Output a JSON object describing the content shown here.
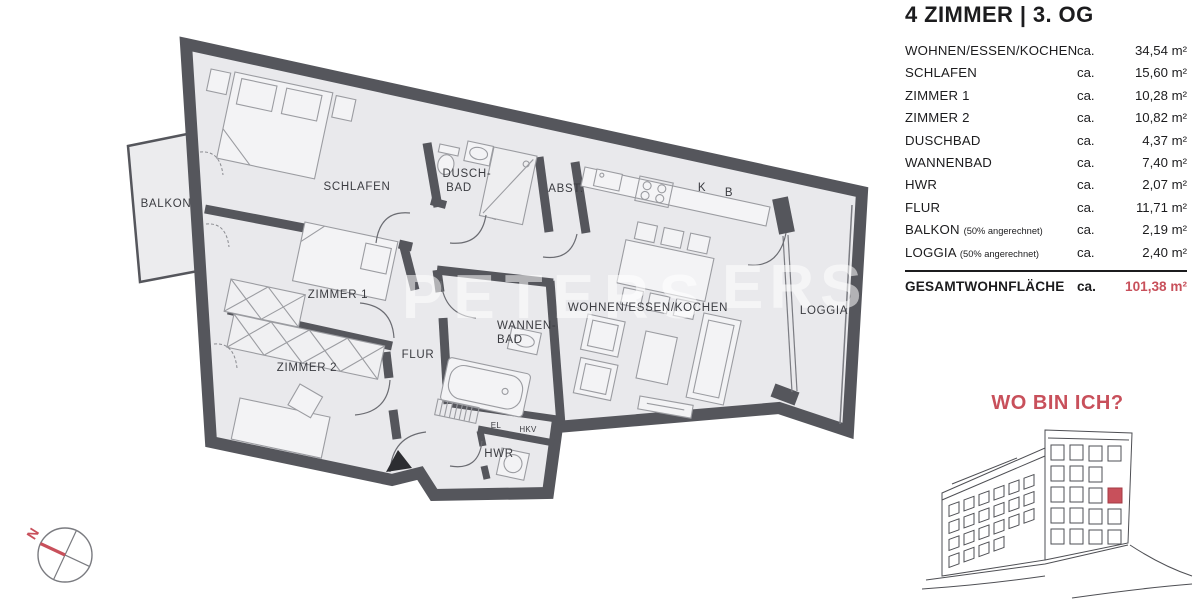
{
  "title": "4 ZIMMER | 3. OG",
  "table": {
    "rows": [
      {
        "label": "WOHNEN/ESSEN/KOCHEN",
        "note": "",
        "ca": "ca.",
        "value": "34,54 m²"
      },
      {
        "label": "SCHLAFEN",
        "note": "",
        "ca": "ca.",
        "value": "15,60 m²"
      },
      {
        "label": "ZIMMER 1",
        "note": "",
        "ca": "ca.",
        "value": "10,28 m²"
      },
      {
        "label": "ZIMMER 2",
        "note": "",
        "ca": "ca.",
        "value": "10,82 m²"
      },
      {
        "label": "DUSCHBAD",
        "note": "",
        "ca": "ca.",
        "value": "4,37 m²"
      },
      {
        "label": "WANNENBAD",
        "note": "",
        "ca": "ca.",
        "value": "7,40 m²"
      },
      {
        "label": "HWR",
        "note": "",
        "ca": "ca.",
        "value": "2,07 m²"
      },
      {
        "label": "FLUR",
        "note": "",
        "ca": "ca.",
        "value": "11,71 m²"
      },
      {
        "label": "BALKON",
        "note": "(50% angerechnet)",
        "ca": "ca.",
        "value": "2,19 m²"
      },
      {
        "label": "LOGGIA",
        "note": "(50% angerechnet)",
        "ca": "ca.",
        "value": "2,40 m²"
      }
    ],
    "total": {
      "label": "GESAMTWOHNFLÄCHE",
      "ca": "ca.",
      "value": "101,38 m²"
    }
  },
  "plan": {
    "labels": {
      "balkon": "BALKON",
      "schlafen": "SCHLAFEN",
      "duschbad1": "DUSCH-",
      "duschbad2": "BAD",
      "abst": "ABST.",
      "k": "K",
      "b": "B",
      "wohnen": "WOHNEN/ESSEN/KOCHEN",
      "zimmer1": "ZIMMER 1",
      "zimmer2": "ZIMMER 2",
      "flur": "FLUR",
      "wannenbad1": "WANNEN-",
      "wannenbad2": "BAD",
      "hwr": "HWR",
      "el": "EL",
      "hkv": "HKV",
      "loggia": "LOGGIA"
    }
  },
  "locator": {
    "heading": "WO BIN ICH?"
  },
  "compass": {
    "north": "N"
  },
  "watermark": {
    "part1": "PETERS",
    "part2": "ERS"
  },
  "colors": {
    "wall": "#55565c",
    "floor": "#e9e9ec",
    "accent_red": "#c8505b"
  }
}
